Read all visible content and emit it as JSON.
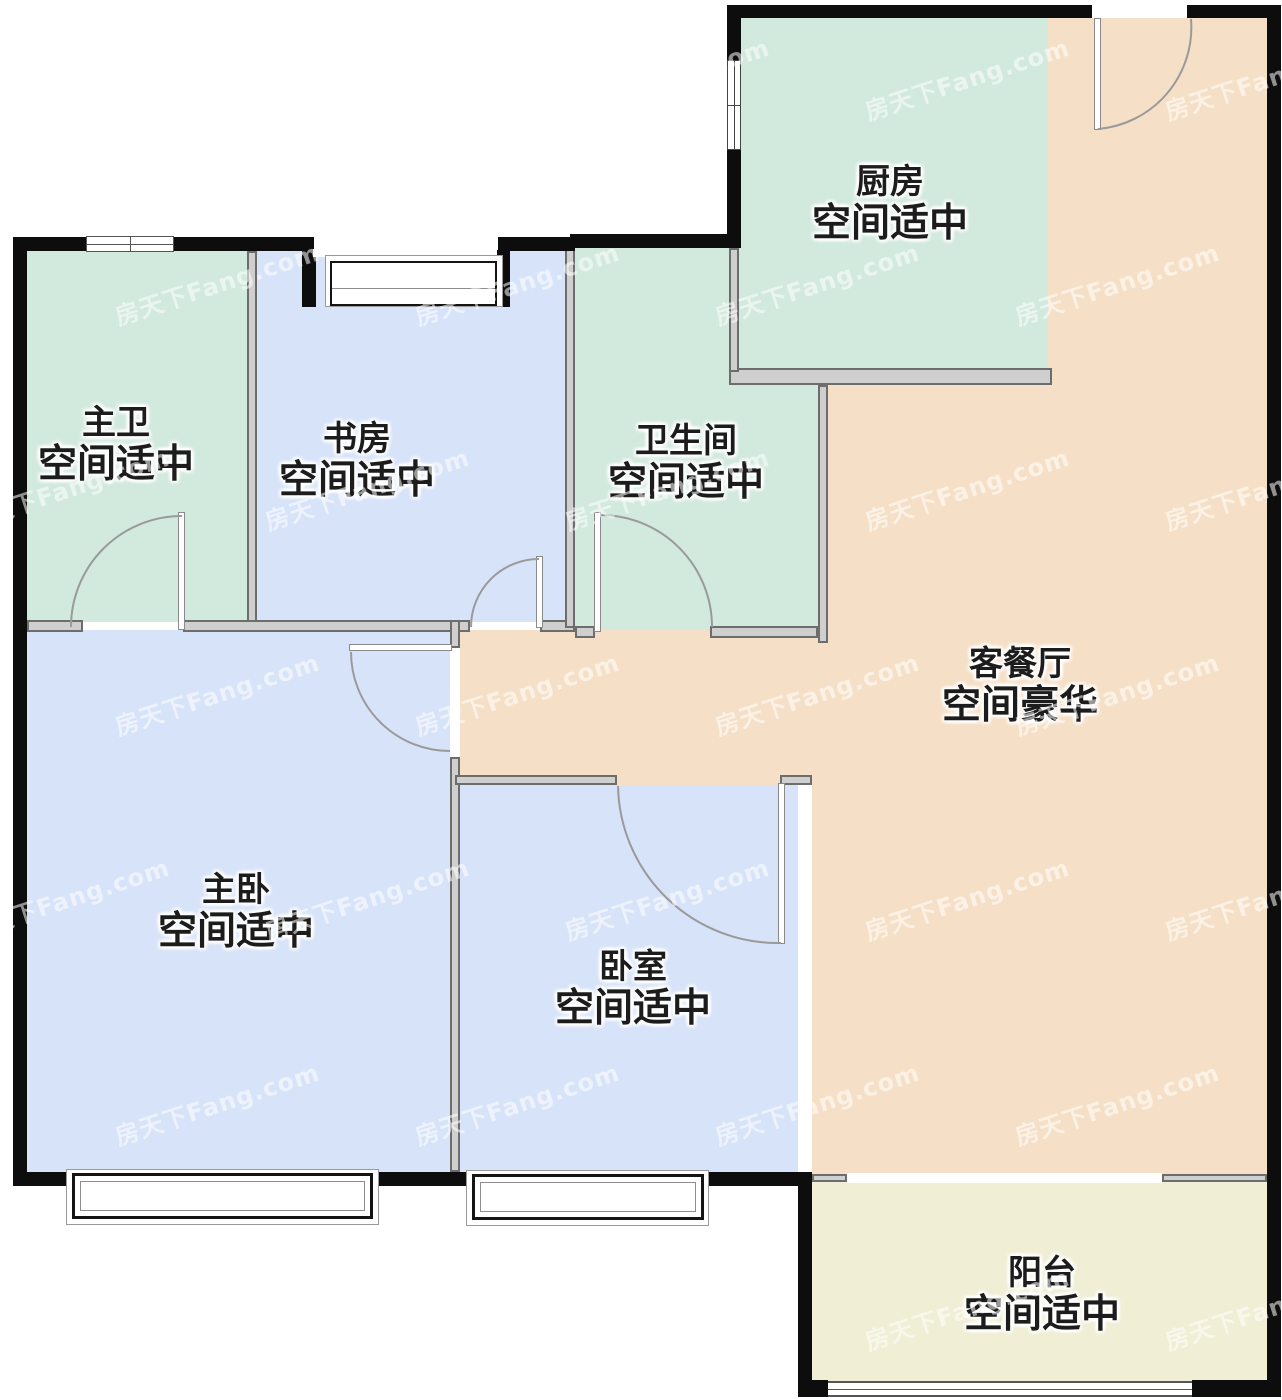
{
  "watermark": {
    "text": "房天下Fang.com"
  },
  "rooms": {
    "master_bath": {
      "name": "主卫",
      "size": "空间适中",
      "color": "#d2e9de"
    },
    "study": {
      "name": "书房",
      "size": "空间适中",
      "color": "#d7e3f8"
    },
    "bathroom": {
      "name": "卫生间",
      "size": "空间适中",
      "color": "#d2e9de"
    },
    "kitchen": {
      "name": "厨房",
      "size": "空间适中",
      "color": "#d2e9de"
    },
    "living_dining": {
      "name": "客餐厅",
      "size": "空间豪华",
      "color": "#f5dfc6"
    },
    "master_bedroom": {
      "name": "主卧",
      "size": "空间适中",
      "color": "#d7e3f8"
    },
    "bedroom": {
      "name": "卧室",
      "size": "空间适中",
      "color": "#d7e3f8"
    },
    "balcony": {
      "name": "阳台",
      "size": "空间适中",
      "color": "#f0eed4"
    }
  },
  "colors": {
    "outer_wall": "#0d0d0d",
    "inner_wall": "#6d6d6d",
    "door_arc": "#9a9a9a",
    "label_text": "#1c1c1c"
  }
}
